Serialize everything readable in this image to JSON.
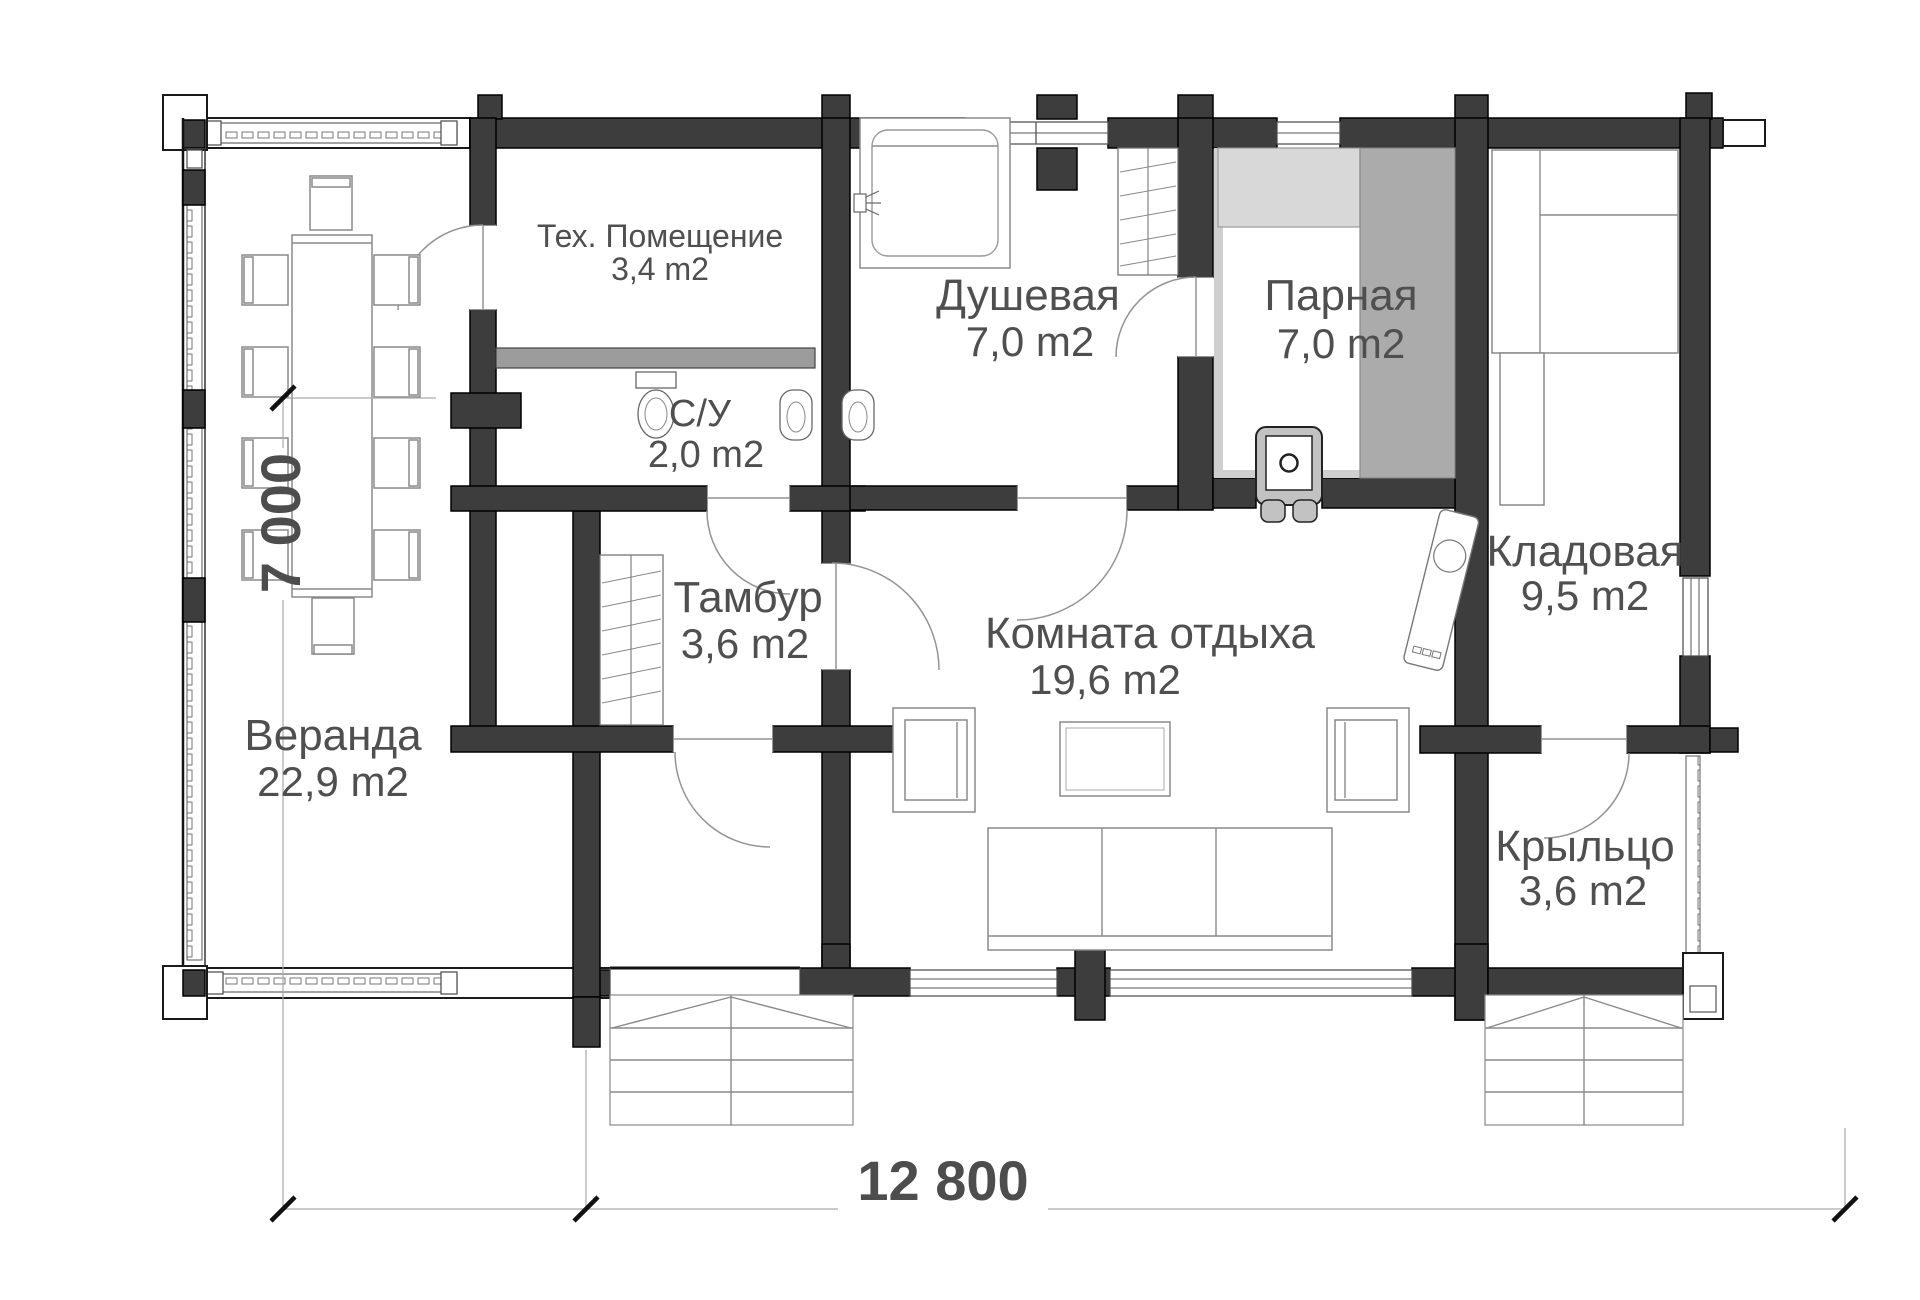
{
  "plan": {
    "title": "Bath house floor plan",
    "dimensions": {
      "width_label": "12 800",
      "height_label": "7 000"
    },
    "rooms": [
      {
        "id": "veranda",
        "name": "Веранда",
        "area": "22,9 m2"
      },
      {
        "id": "tech",
        "name": "Тех. Помещение",
        "area": "3,4 m2"
      },
      {
        "id": "su",
        "name": "С/У",
        "area": "2,0 m2"
      },
      {
        "id": "tambour",
        "name": "Тамбур",
        "area": "3,6 m2"
      },
      {
        "id": "shower",
        "name": "Душевая",
        "area": "7,0 m2"
      },
      {
        "id": "steam",
        "name": "Парная",
        "area": "7,0 m2"
      },
      {
        "id": "rest",
        "name": "Комната отдыха",
        "area": "19,6 m2"
      },
      {
        "id": "storage",
        "name": "Кладовая",
        "area": "9,5 m2"
      },
      {
        "id": "porch",
        "name": "Крыльцо",
        "area": "3,6 m2"
      }
    ],
    "colors": {
      "wall": "#3d3d3d",
      "outline": "#111111",
      "bench_light": "#d8d8d8",
      "bench_mid": "#ababab",
      "partition_gray": "#9c9c9c",
      "stove_gray": "#c2c2c2",
      "label_text": "#4f4f4f"
    }
  }
}
